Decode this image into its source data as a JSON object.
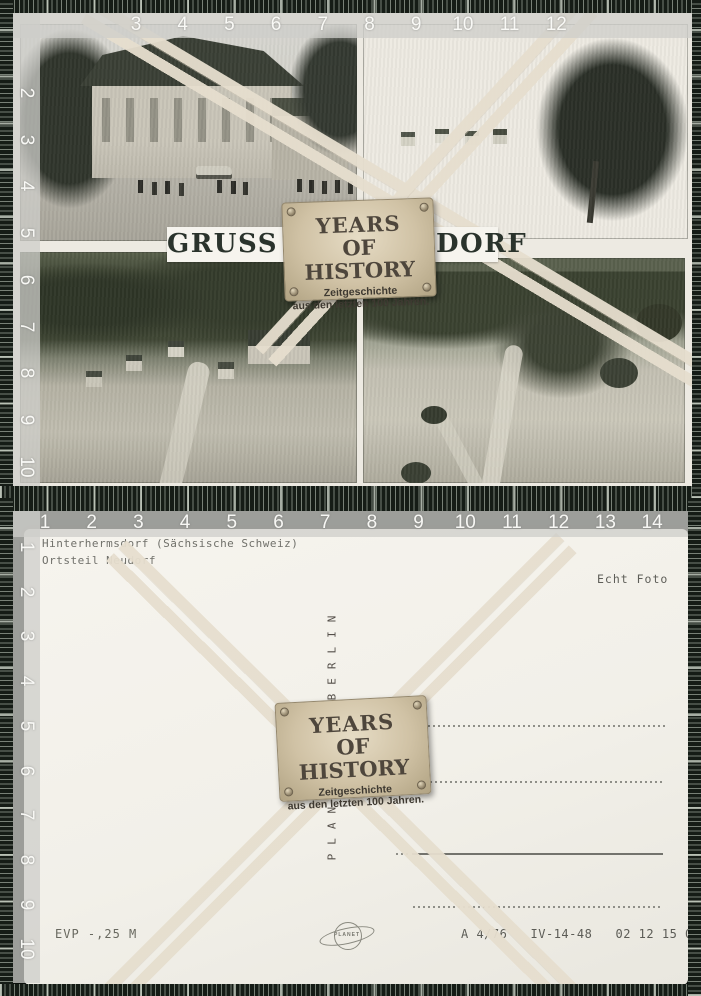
{
  "watermark_label": {
    "title_line1": "YEARS",
    "title_line2": "OF HISTORY",
    "subtitle_line1": "Zeitgeschichte",
    "subtitle_line2": "aus den letzten 100 Jahren."
  },
  "postcard_front": {
    "greeting": "GRUSS AUS NEUDORF"
  },
  "postcard_back": {
    "location_line1": "Hinterhermsdorf (Sächsische Schweiz)",
    "location_line2": "Ortsteil Neudorf",
    "photo_type": "Echt Foto",
    "publisher_word_upper": "BERLIN",
    "publisher_word_lower": "PLANET",
    "logo_text": "PLANET",
    "price": "EVP -,25 M",
    "print_code": "A 4/76   IV-14-48   02 12 15 072 M"
  },
  "rulers": {
    "front_top": [
      "3",
      "4",
      "5",
      "6",
      "7",
      "8",
      "9",
      "10",
      "11",
      "12"
    ],
    "front_left": [
      "2",
      "3",
      "4",
      "5",
      "6",
      "7",
      "8",
      "9",
      "10"
    ],
    "back_top": [
      "1",
      "2",
      "3",
      "4",
      "5",
      "6",
      "7",
      "8",
      "9",
      "10",
      "11",
      "12",
      "13",
      "14",
      "15"
    ],
    "back_left": [
      "1",
      "2",
      "3",
      "4",
      "5",
      "6",
      "7",
      "8",
      "9",
      "10"
    ]
  },
  "colors": {
    "tape_dark_green": "#151c16",
    "ruler_band_gray": "#cecec9",
    "label_parchment": "#d0c2a5",
    "front_paper": "#edeae2",
    "back_paper": "#f3f1ea",
    "greeting_ink": "#2a332c"
  }
}
